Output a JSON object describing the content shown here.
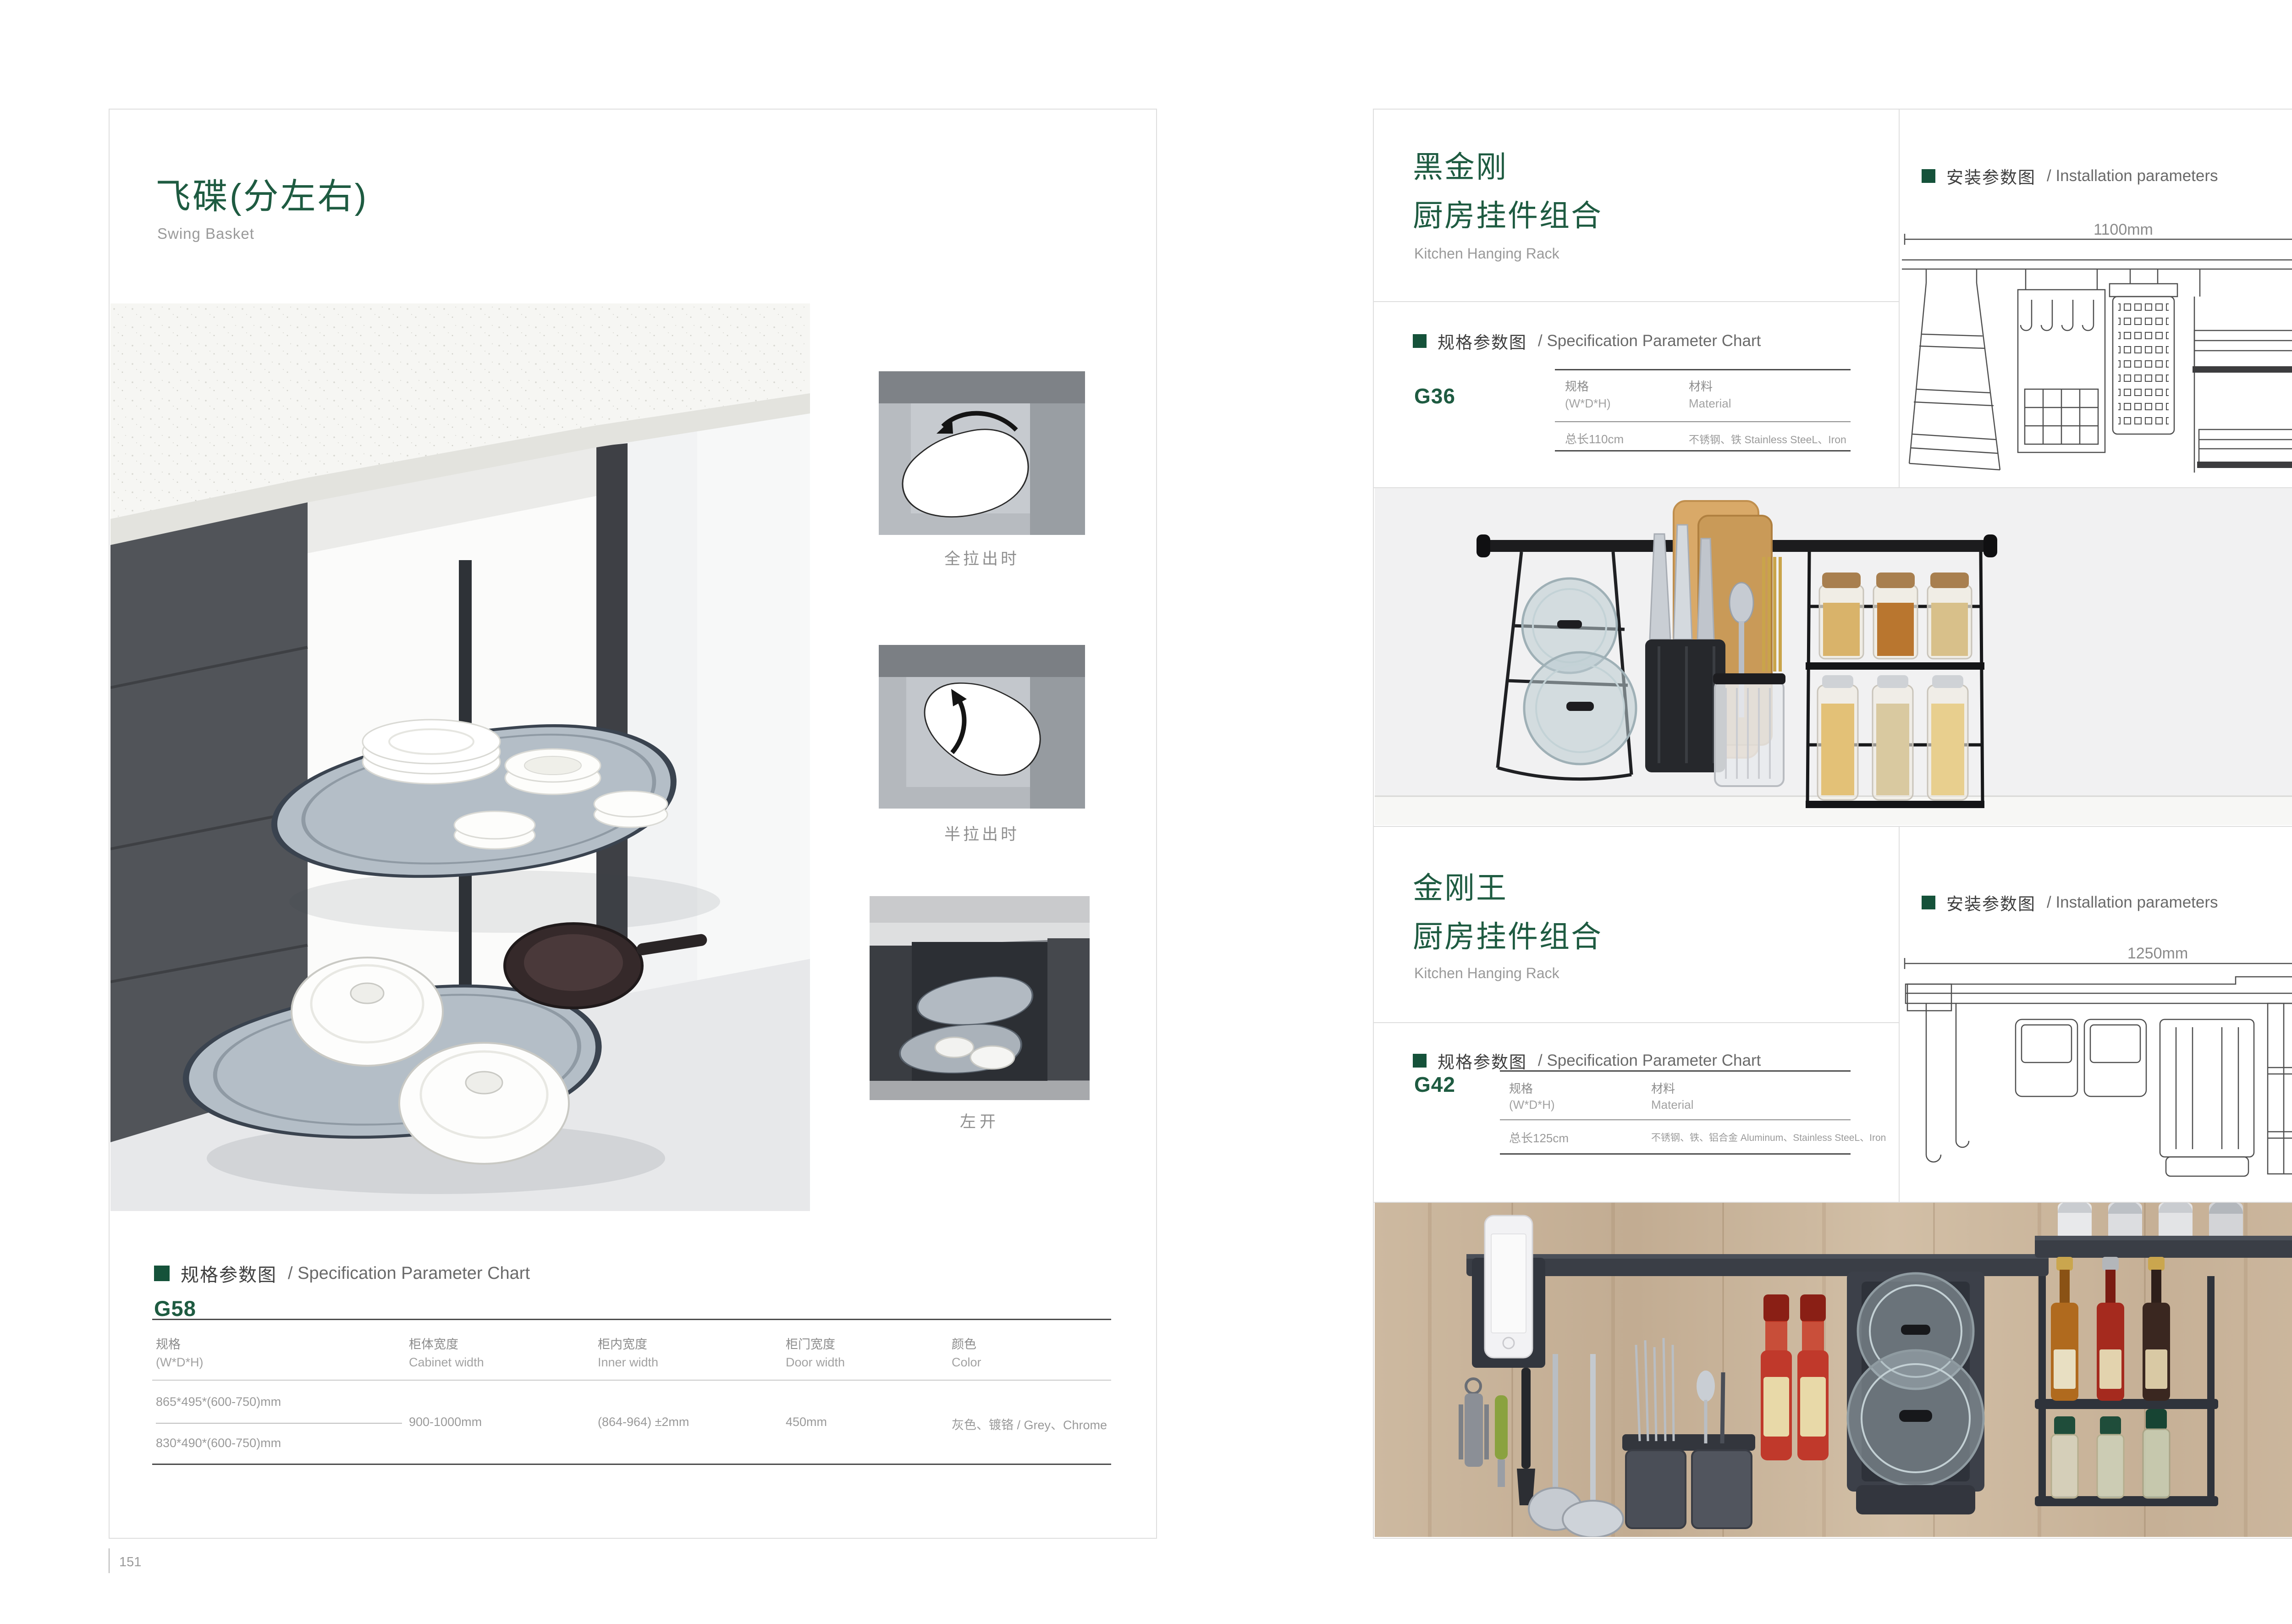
{
  "colors": {
    "brand_green": "#1e5b41",
    "bullet_green": "#15523a",
    "subtitle_gray": "#9a9a9a",
    "table_line_dark": "#4b4b4b"
  },
  "left_page": {
    "number": "151",
    "title_cn": "飞碟(分左右)",
    "title_en": "Swing Basket",
    "captions": {
      "full_out": "全拉出时",
      "half_out": "半拉出时",
      "left_open": "左开"
    },
    "spec": {
      "label_cn": "规格参数图",
      "label_en": "/ Specification Parameter Chart",
      "model": "G58",
      "col1_cn": "规格",
      "col1_en": "(W*D*H)",
      "col2_cn": "柜体宽度",
      "col2_en": "Cabinet width",
      "col3_cn": "柜内宽度",
      "col3_en": "Inner width",
      "col4_cn": "柜门宽度",
      "col4_en": "Door width",
      "col5_cn": "颜色",
      "col5_en": "Color",
      "size_a": "865*495*(600-750)mm",
      "size_b": "830*490*(600-750)mm",
      "cabinet_width": "900-1000mm",
      "inner_width": "(864-964) ±2mm",
      "door_width": "450mm",
      "color": "灰色、镀铬 / Grey、Chrome"
    }
  },
  "right_page": {
    "number": "152",
    "spec_label_cn": "规格参数图",
    "spec_label_en": "/ Specification Parameter Chart",
    "install_label_cn": "安装参数图",
    "install_label_en": "/ Installation parameters",
    "product1": {
      "title_cn1": "黑金刚",
      "title_cn2": "厨房挂件组合",
      "title_en": "Kitchen Hanging Rack",
      "model": "G36",
      "col1_cn": "规格",
      "col1_en": "(W*D*H)",
      "col2_cn": "材料",
      "col2_en": "Material",
      "val1": "总长110cm",
      "val2": "不锈钢、铁  Stainless SteeL、Iron",
      "dim_w": "1100mm",
      "dim_h": "420mm"
    },
    "product2": {
      "title_cn1": "金刚王",
      "title_cn2": "厨房挂件组合",
      "title_en": "Kitchen Hanging Rack",
      "model": "G42",
      "col1_cn": "规格",
      "col1_en": "(W*D*H)",
      "col2_cn": "材料",
      "col2_en": "Material",
      "val1": "总长125cm",
      "val2": "不锈钢、铁、铝合金  Aluminum、Stainless SteeL、Iron",
      "dim_w": "1250mm",
      "dim_h": "430mm"
    }
  }
}
